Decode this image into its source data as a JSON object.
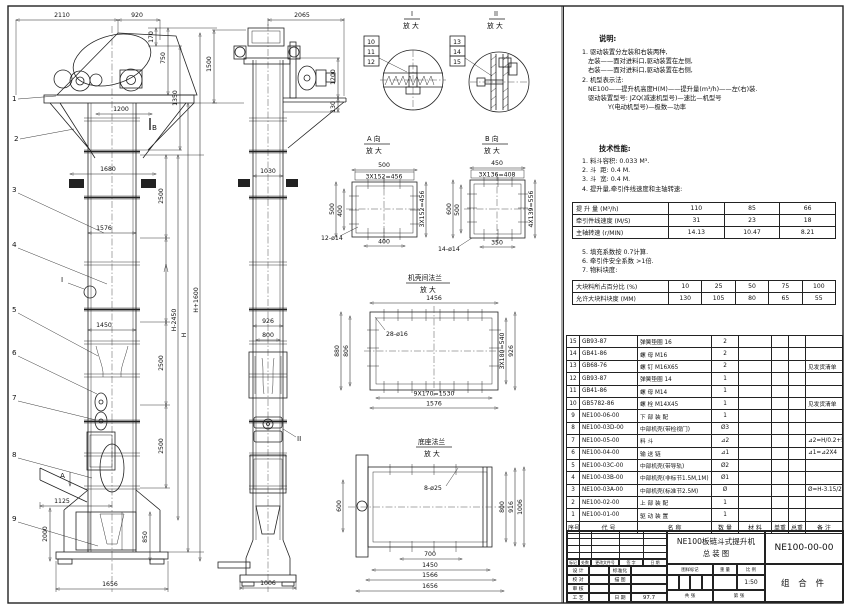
{
  "front": {
    "balloons": [
      "1",
      "2",
      "3",
      "4",
      "5",
      "6",
      "7",
      "8",
      "9"
    ],
    "markers": {
      "a": "A",
      "b": "B",
      "i": "I"
    },
    "dims": {
      "top1": "2110",
      "top2": "920",
      "h170": "170",
      "h750": "750",
      "h1350": "1350",
      "neck": "1200",
      "w1680": "1680",
      "w1576": "1576",
      "w1450": "1450",
      "sec": "2500",
      "base_off": "1125",
      "h2000": "2000",
      "h850": "850",
      "w1656": "1656",
      "hm": "H-2450",
      "h": "H",
      "hp": "H+1600"
    }
  },
  "side": {
    "marker": "II",
    "dims": {
      "top": "2065",
      "h1500": "1500",
      "h1200": "1200",
      "h130": "130",
      "w1030": "1030",
      "w926": "926",
      "w800": "800",
      "w1006": "1006"
    }
  },
  "detailI": {
    "num": "I",
    "zoom": "放 大",
    "balloons": [
      "10",
      "11",
      "12"
    ]
  },
  "detailII": {
    "num": "II",
    "zoom": "放 大",
    "balloons": [
      "13",
      "14",
      "15"
    ]
  },
  "viewA": {
    "title": "A 向",
    "zoom": "放 大",
    "dims": {
      "top": "500",
      "pitch": "3X152=456",
      "left": "500",
      "left2": "400",
      "right": "3X152=456",
      "bottom": "400",
      "holes": "12-ø14"
    }
  },
  "viewB": {
    "title": "B 向",
    "zoom": "放 大",
    "dims": {
      "top": "450",
      "pitch": "3X136=408",
      "left": "600",
      "left2": "500",
      "right": "4X139=556",
      "bottom": "350",
      "holes": "14-ø14"
    }
  },
  "flange": {
    "title": "机壳间法兰",
    "zoom": "放 大",
    "dims": {
      "top": "1456",
      "left": "880",
      "left2": "806",
      "right": "3X180=540",
      "right2": "926",
      "bottom": "9X170=1530",
      "bottom2": "1576",
      "holes": "28-ø16"
    }
  },
  "baseFlange": {
    "title": "底座法兰",
    "zoom": "放 大",
    "dims": {
      "left": "600",
      "right1": "800",
      "right2": "916",
      "right3": "1006",
      "b700": "700",
      "b1450": "1450",
      "b1566": "1566",
      "b1656": "1656",
      "holes": "8-ø25"
    }
  },
  "notes": {
    "heading": "说明:",
    "l1": "1. 驱动装置分左装和右装两种,",
    "l2": "   左装——面对进料口,驱动装置在左侧,",
    "l3": "   右装——面对进料口,驱动装置在右侧,",
    "l4": "2. 机型表示法:",
    "l5": "   NE100——提升机高度H(M)——提升量(m³/h)——左(右)装.",
    "l6": "   驱动装置型号: JZQ(减速机型号)—速比—机型号",
    "l7": "             Y(电动机型号)—极数—功率"
  },
  "tech": {
    "heading": "技术性能:",
    "l1": "1. 料斗容积: 0.033 M³.",
    "l2": "2. 斗  距: 0.4 M.",
    "l3": "3. 斗  宽: 0.4 M.",
    "l4": "4. 提升量,牵引件线速度和主轴转速:",
    "l5": "5. 填充系数按 0.7计算.",
    "l6": "6. 牵引件安全系数 >1倍.",
    "l7": "7. 物料块度:"
  },
  "perfTable": {
    "rows": [
      {
        "label": "提 升 量  (M³/h)",
        "v1": "110",
        "v2": "85",
        "v3": "66"
      },
      {
        "label": "牵引件线速度 (M/S)",
        "v1": "31",
        "v2": "23",
        "v3": "18"
      },
      {
        "label": "主轴转速  (r/MIN)",
        "v1": "14.13",
        "v2": "10.47",
        "v3": "8.21"
      }
    ]
  },
  "lumpTable": {
    "r1label": "大块料所占百分比 (%)",
    "r1": [
      "10",
      "25",
      "50",
      "75",
      "100"
    ],
    "r2label": "允许大块料块度 (MM)",
    "r2": [
      "130",
      "105",
      "80",
      "65",
      "55"
    ]
  },
  "bom": {
    "header": {
      "no": "序号",
      "code": "代  号",
      "name": "名  称",
      "qty": "数 量",
      "mat": "材  料",
      "unit": "单重",
      "total": "总重",
      "note": "备  注"
    },
    "rows": [
      {
        "no": "15",
        "code": "GB93-87",
        "name": "弹簧垫圈  16",
        "qty": "2",
        "note": ""
      },
      {
        "no": "14",
        "code": "GB41-86",
        "name": "螺 母  M16",
        "qty": "2",
        "note": ""
      },
      {
        "no": "13",
        "code": "GB68-76",
        "name": "螺 钉  M16X65",
        "qty": "2",
        "note": "见发货清单"
      },
      {
        "no": "12",
        "code": "GB93-87",
        "name": "弹簧垫圈  14",
        "qty": "1",
        "note": ""
      },
      {
        "no": "11",
        "code": "GB41-86",
        "name": "螺 母  M14",
        "qty": "1",
        "note": ""
      },
      {
        "no": "10",
        "code": "GB5782-86",
        "name": "螺 栓  M14X45",
        "qty": "1",
        "note": "见发货清单"
      },
      {
        "no": "9",
        "code": "NE100-06-00",
        "name": "下 部 装 配",
        "qty": "1",
        "note": ""
      },
      {
        "no": "8",
        "code": "NE100-03D-00",
        "name": "中部机壳(带检视门)",
        "qty": "Ø3",
        "note": ""
      },
      {
        "no": "7",
        "code": "NE100-05-00",
        "name": "料  斗",
        "qty": "⊿2",
        "note": "⊿2=H/0.2+5.75"
      },
      {
        "no": "6",
        "code": "NE100-04-00",
        "name": "输 送 链",
        "qty": "⊿1",
        "note": "⊿1=⊿2X4"
      },
      {
        "no": "5",
        "code": "NE100-03C-00",
        "name": "中部机壳(带导轨)",
        "qty": "Ø2",
        "note": ""
      },
      {
        "no": "4",
        "code": "NE100-03B-00",
        "name": "中部机壳(非标节1.5M,1M)",
        "qty": "Ø1",
        "note": ""
      },
      {
        "no": "3",
        "code": "NE100-03A-00",
        "name": "中部机壳(标准节2.5M)",
        "qty": "Ø",
        "note": "Ø=H-3.15/2.5"
      },
      {
        "no": "2",
        "code": "NE100-02-00",
        "name": "上 部 装 配",
        "qty": "1",
        "note": ""
      },
      {
        "no": "1",
        "code": "NE100-01-00",
        "name": "驱 动 装 置",
        "qty": "1",
        "note": ""
      }
    ]
  },
  "titleBlock": {
    "product": "NE100板链斗式提升机",
    "title": "总  装  图",
    "drawingNo": "NE100-00-00",
    "part": "组 合 件",
    "scale": "1:50",
    "date": "97.7",
    "labels": {
      "mark": "标记",
      "count": "处数",
      "doc": "更改文件号",
      "sign": "签 字",
      "date": "日 期",
      "design": "设 计",
      "check": "校 对",
      "audit": "审 核",
      "craft": "工 艺",
      "std": "标准化",
      "trace": "描 图",
      "date2": "日 期",
      "stamp": "图样标记",
      "weight": "重 量",
      "ratio": "比 例",
      "total": "共  张",
      "page": "第  张"
    }
  }
}
